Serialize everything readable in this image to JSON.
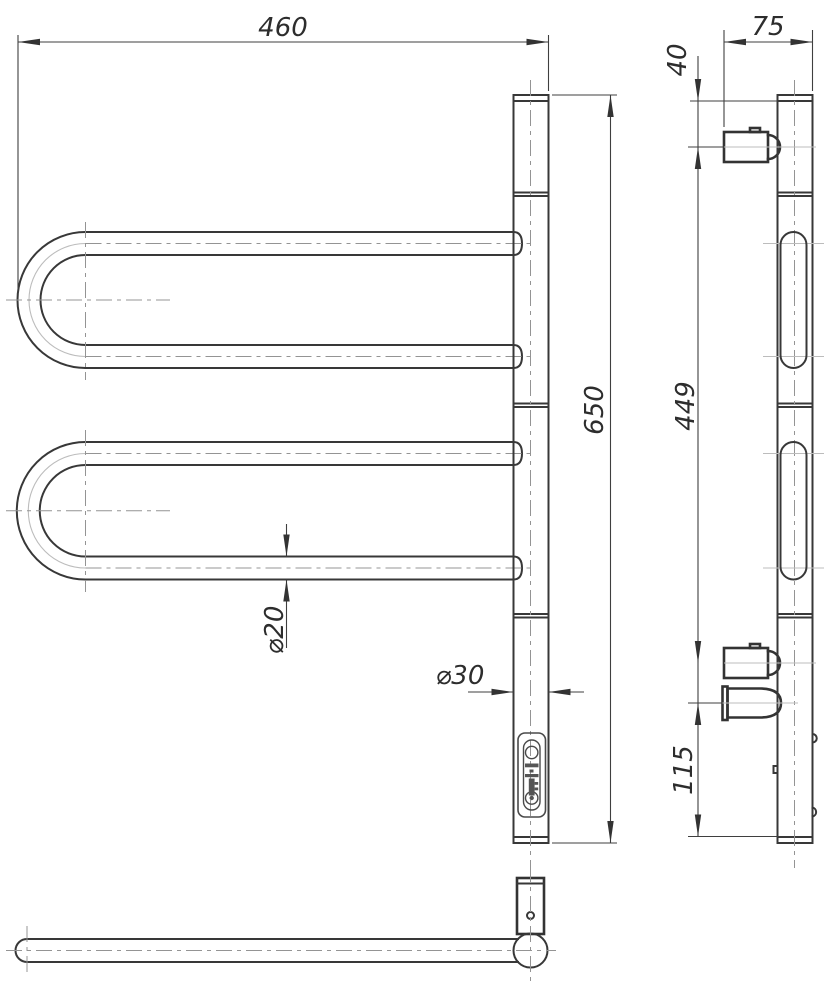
{
  "drawing": {
    "type": "technical-orthographic-views",
    "subject": "swivel towel rail with wall brackets",
    "colors": {
      "background": "#ffffff",
      "object_line": "#383838",
      "thin_line": "#3f3f3f",
      "centerline": "#949494",
      "text": "#2d2d2d"
    },
    "front_view": {
      "dim_overall_width": "460",
      "dim_overall_height": "650",
      "dim_tube_diameter": "⌀20",
      "dim_post_diameter": "⌀30"
    },
    "side_view": {
      "dim_overall_depth": "75",
      "dim_top_to_bracket": "40",
      "dim_bracket_spacing": "449",
      "dim_power_to_bottom": "115"
    }
  }
}
